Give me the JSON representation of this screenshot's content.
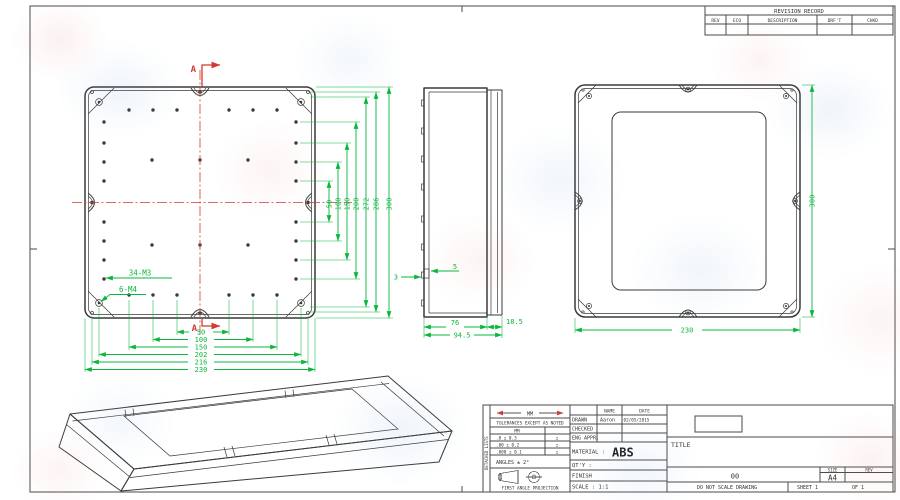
{
  "sheet": {
    "revision_table": {
      "title": "REVISION RECORD",
      "columns": [
        "REV",
        "ECO",
        "DESCRIPTION",
        "DRF'T",
        "CHKD"
      ]
    },
    "front_view": {
      "section_marker_top": "A",
      "section_marker_bottom": "A",
      "vertical_dims": [
        "50",
        "100",
        "150",
        "200",
        "272",
        "286",
        "300"
      ],
      "horizontal_dims": [
        "50",
        "100",
        "150",
        "202",
        "216",
        "230"
      ],
      "callout_m3": "34-M3",
      "callout_m4": "6-M4"
    },
    "side_view": {
      "wall_dim": "3",
      "boss_dim": "5",
      "base_depth_dim": "76",
      "total_depth_dim": "94.5",
      "lid_depth_dim": "18.5"
    },
    "back_view": {
      "width_dim": "230",
      "height_dim": "300"
    },
    "title_block": {
      "stock_label": "DETACHED LISTS",
      "units_symbol_label": "MM",
      "tolerance_note": "TOLERANCES EXCEPT AS NOTED",
      "tolerance_unit": "MM",
      "tolerances": [
        {
          "value": ".0 ± 0.3",
          "mark": "±"
        },
        {
          "value": ".00 ± 0.2",
          "mark": "±"
        },
        {
          "value": ".000 ± 0.1",
          "mark": "±"
        }
      ],
      "angles_note": "ANGLES ± 2°",
      "projection_note": "FIRST ANGLE PROJECTION",
      "name_header": "NAME",
      "date_header": "DATE",
      "drawn_label": "DRAWN",
      "drawn_name": "Aaron",
      "drawn_date": "02/05/2015",
      "checked_label": "CHECKED",
      "eng_appr_label": "ENG APPR.",
      "material_label": "MATERIAL :",
      "material_value": "ABS",
      "qty_label": "QT'Y :",
      "finish_label": "FINISH",
      "scale_label": "SCALE : 1:1",
      "title_label": "TITLE",
      "drawing_number": "00",
      "size_label": "SIZE",
      "size_value": "A4",
      "rev_label": "REV",
      "do_not_scale_note": "DO NOT SCALE DRAWING",
      "sheet_label": "SHEET 1",
      "sheet_of_label": "OF 1"
    },
    "colors": {
      "line": "#3a3a3a",
      "dimension_green": "#0ab73c",
      "centerline_red": "#d13b32"
    }
  }
}
